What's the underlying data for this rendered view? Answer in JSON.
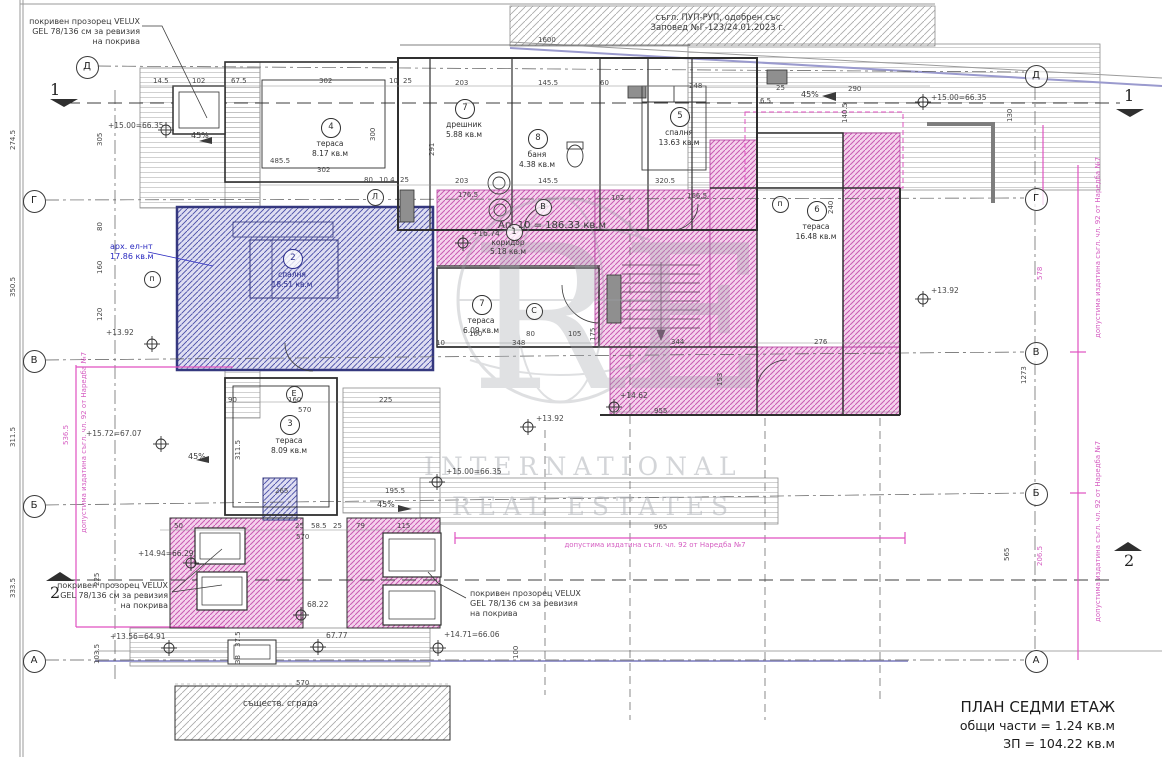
{
  "colors": {
    "regulation_pink": "#d55ec2",
    "hatch_pink": "#c855b4",
    "hatch_blue": "#454aa2",
    "note_blue": "#2a2ac0",
    "wall": "#2f2f2f",
    "roof_edge_purple": "#9a9ace"
  },
  "title_block": {
    "line1": "ПЛАН СЕДМИ ЕТАЖ",
    "line2": "общи части = 1.24 кв.м",
    "line3": "ЗП = 104.22 кв.м"
  },
  "watermark": {
    "monogram": "RE",
    "line1": "INTERNATIONAL",
    "line2": "REAL ESTATES"
  },
  "apartment_total": "Ап. 10 = 186.33 кв.м",
  "rooms": [
    {
      "num": "4",
      "name": "тераса",
      "area": "8.17 кв.м",
      "x": 330,
      "y": 118
    },
    {
      "num": "7",
      "name": "дрешник",
      "area": "5.88 кв.м",
      "x": 464,
      "y": 99
    },
    {
      "num": "8",
      "name": "баня",
      "area": "4.38 кв.м",
      "x": 537,
      "y": 129
    },
    {
      "num": "5",
      "name": "спалня",
      "area": "13.63 кв.м",
      "x": 679,
      "y": 107
    },
    {
      "num": "6",
      "name": "тераса",
      "area": "16.48 кв.м",
      "x": 816,
      "y": 201
    },
    {
      "num": "2",
      "name": "спалня",
      "area": "18.51 кв.м",
      "x": 292,
      "y": 249,
      "blue": true
    },
    {
      "num": "7",
      "name": "тераса",
      "area": "6.09 кв.м",
      "x": 481,
      "y": 295
    },
    {
      "num": "3",
      "name": "тераса",
      "area": "8.09 кв.м",
      "x": 289,
      "y": 415
    }
  ],
  "annotations": [
    {
      "id": "approval-note",
      "t": "съгл. ПУП-РУП, одобрен със\nЗаповед №Г-123/24.01.2023 г.",
      "x": 718,
      "y": 13,
      "s": 8.5,
      "a": "c"
    },
    {
      "id": "velux-note-top-left",
      "t": "покривен прозорец VELUX\nGEL 78/136 см за ревизия\nна покрива",
      "x": 140,
      "y": 17,
      "s": 8,
      "a": "r"
    },
    {
      "id": "velux-note-bottom-left",
      "t": "покривен прозорец VELUX\nGEL 78/136 см за ревизия\nна покрива",
      "x": 168,
      "y": 581,
      "s": 8,
      "a": "r"
    },
    {
      "id": "velux-note-bottom-center",
      "t": "покривен прозорец VELUX\nGEL 78/136 см за ревизия\nна покрива",
      "x": 470,
      "y": 589,
      "s": 8,
      "a": "l"
    },
    {
      "id": "arch-element-note",
      "t": "арх. ел-нт\n17.86 кв.м",
      "x": 110,
      "y": 242,
      "s": 8,
      "a": "l",
      "col": "#2a2ac0"
    },
    {
      "id": "apartment-total",
      "t": "Ап. 10 = 186.33 кв.м",
      "x": 498,
      "y": 220,
      "s": 10,
      "a": "l"
    },
    {
      "id": "corridor-label",
      "t": "коридор\n5.18 кв.м",
      "x": 508,
      "y": 238,
      "s": 7.5,
      "a": "c"
    },
    {
      "id": "existing-building-label",
      "t": "съществ. сграда",
      "x": 243,
      "y": 699,
      "s": 8.5,
      "a": "l"
    },
    {
      "id": "regulation-note-mid",
      "t": "допустима издатина съгл. чл. 92 от Наредба №7",
      "x": 655,
      "y": 541,
      "s": 7,
      "a": "c",
      "col": "#d55ec2"
    },
    {
      "id": "regulation-note-left",
      "t": "допустима издатина съгл. чл. 92 от Наредба №7",
      "x": 80,
      "y": 533,
      "s": 7,
      "rot": 1,
      "col": "#d55ec2"
    },
    {
      "id": "regulation-note-right-1",
      "t": "допустима издатина съгл. чл. 92 от Наредба №7",
      "x": 1094,
      "y": 338,
      "s": 7,
      "rot": 1,
      "col": "#d55ec2"
    },
    {
      "id": "regulation-note-right-2",
      "t": "допустима издатина съгл. чл. 92 от Наредба №7",
      "x": 1094,
      "y": 622,
      "s": 7,
      "rot": 1,
      "col": "#d55ec2"
    },
    {
      "id": "slope-45-a",
      "t": "45%",
      "x": 191,
      "y": 131,
      "s": 8,
      "a": "l"
    },
    {
      "id": "slope-45-b",
      "t": "45%",
      "x": 801,
      "y": 90,
      "s": 8,
      "a": "l"
    },
    {
      "id": "slope-45-c",
      "t": "45%",
      "x": 188,
      "y": 452,
      "s": 8,
      "a": "l"
    },
    {
      "id": "slope-45-d",
      "t": "45%",
      "x": 377,
      "y": 500,
      "s": 8,
      "a": "l"
    }
  ],
  "elevations": [
    {
      "t": "+15.00=66.35",
      "x": 108,
      "y": 121
    },
    {
      "t": "+15.00=66.35",
      "x": 931,
      "y": 93
    },
    {
      "t": "+16.74",
      "x": 472,
      "y": 229
    },
    {
      "t": "+13.92",
      "x": 106,
      "y": 328
    },
    {
      "t": "+13.92",
      "x": 536,
      "y": 414
    },
    {
      "t": "+13.92",
      "x": 931,
      "y": 286
    },
    {
      "t": "+15.72=67.07",
      "x": 86,
      "y": 429
    },
    {
      "t": "+15.00=66.35",
      "x": 446,
      "y": 467
    },
    {
      "t": "+14.94=66.29",
      "x": 138,
      "y": 549
    },
    {
      "t": "+13.56=64.91",
      "x": 110,
      "y": 632
    },
    {
      "t": "68.22",
      "x": 307,
      "y": 600
    },
    {
      "t": "67.77",
      "x": 326,
      "y": 631
    },
    {
      "t": "+14.71=66.06",
      "x": 444,
      "y": 630
    },
    {
      "t": "+14.62",
      "x": 620,
      "y": 391
    }
  ],
  "dims": [
    {
      "t": "1600",
      "x": 538,
      "y": 36
    },
    {
      "t": "14.5",
      "x": 153,
      "y": 77
    },
    {
      "t": "102",
      "x": 192,
      "y": 77
    },
    {
      "t": "67.5",
      "x": 231,
      "y": 77
    },
    {
      "t": "302",
      "x": 319,
      "y": 77
    },
    {
      "t": "10",
      "x": 389,
      "y": 77
    },
    {
      "t": "25",
      "x": 403,
      "y": 77
    },
    {
      "t": "203",
      "x": 455,
      "y": 79
    },
    {
      "t": "145.5",
      "x": 538,
      "y": 79
    },
    {
      "t": "60",
      "x": 600,
      "y": 79
    },
    {
      "t": "248",
      "x": 689,
      "y": 82
    },
    {
      "t": "25",
      "x": 776,
      "y": 84
    },
    {
      "t": "290",
      "x": 848,
      "y": 85
    },
    {
      "t": "6.5",
      "x": 760,
      "y": 97
    },
    {
      "t": "485.5",
      "x": 270,
      "y": 157
    },
    {
      "t": "302",
      "x": 317,
      "y": 166
    },
    {
      "t": "80",
      "x": 364,
      "y": 176
    },
    {
      "t": "10.4",
      "x": 379,
      "y": 176
    },
    {
      "t": "25",
      "x": 400,
      "y": 176
    },
    {
      "t": "203",
      "x": 455,
      "y": 177
    },
    {
      "t": "176.5",
      "x": 458,
      "y": 191
    },
    {
      "t": "145.5",
      "x": 538,
      "y": 177
    },
    {
      "t": "102",
      "x": 611,
      "y": 194
    },
    {
      "t": "320.5",
      "x": 655,
      "y": 177
    },
    {
      "t": "166.5",
      "x": 687,
      "y": 192
    },
    {
      "t": "300",
      "x": 369,
      "y": 141,
      "r": 1
    },
    {
      "t": "291",
      "x": 428,
      "y": 156,
      "r": 1
    },
    {
      "t": "140.5",
      "x": 841,
      "y": 123,
      "r": 1
    },
    {
      "t": "130",
      "x": 1006,
      "y": 122,
      "r": 1
    },
    {
      "t": "240",
      "x": 827,
      "y": 214,
      "r": 1
    },
    {
      "t": "160",
      "x": 469,
      "y": 330
    },
    {
      "t": "80",
      "x": 526,
      "y": 330
    },
    {
      "t": "105",
      "x": 568,
      "y": 330
    },
    {
      "t": "10",
      "x": 436,
      "y": 339
    },
    {
      "t": "348",
      "x": 512,
      "y": 339
    },
    {
      "t": "175",
      "x": 589,
      "y": 341,
      "r": 1
    },
    {
      "t": "153",
      "x": 716,
      "y": 386,
      "r": 1
    },
    {
      "t": "344",
      "x": 671,
      "y": 338
    },
    {
      "t": "276",
      "x": 814,
      "y": 338
    },
    {
      "t": "955",
      "x": 654,
      "y": 407
    },
    {
      "t": "965",
      "x": 654,
      "y": 523
    },
    {
      "t": "90",
      "x": 228,
      "y": 396
    },
    {
      "t": "160",
      "x": 288,
      "y": 396
    },
    {
      "t": "225",
      "x": 379,
      "y": 396
    },
    {
      "t": "570",
      "x": 298,
      "y": 406
    },
    {
      "t": "265",
      "x": 275,
      "y": 487
    },
    {
      "t": "195.5",
      "x": 385,
      "y": 487
    },
    {
      "t": "311.5",
      "x": 234,
      "y": 460,
      "r": 1
    },
    {
      "t": "50",
      "x": 174,
      "y": 522
    },
    {
      "t": "25",
      "x": 295,
      "y": 522
    },
    {
      "t": "58.5",
      "x": 311,
      "y": 522
    },
    {
      "t": "25",
      "x": 333,
      "y": 522
    },
    {
      "t": "79",
      "x": 356,
      "y": 522
    },
    {
      "t": "115",
      "x": 397,
      "y": 522
    },
    {
      "t": "570",
      "x": 296,
      "y": 533
    },
    {
      "t": "570",
      "x": 296,
      "y": 679
    },
    {
      "t": "305",
      "x": 96,
      "y": 146,
      "r": 1
    },
    {
      "t": "80",
      "x": 96,
      "y": 231,
      "r": 1
    },
    {
      "t": "160",
      "x": 96,
      "y": 274,
      "r": 1
    },
    {
      "t": "120",
      "x": 96,
      "y": 321,
      "r": 1
    },
    {
      "t": "225",
      "x": 93,
      "y": 586,
      "r": 1
    },
    {
      "t": "103.5",
      "x": 93,
      "y": 664,
      "r": 1
    },
    {
      "t": "274.5",
      "x": 9,
      "y": 150,
      "r": 1
    },
    {
      "t": "350.5",
      "x": 9,
      "y": 297,
      "r": 1
    },
    {
      "t": "311.5",
      "x": 9,
      "y": 447,
      "r": 1
    },
    {
      "t": "333.5",
      "x": 9,
      "y": 598,
      "r": 1
    },
    {
      "t": "37.5",
      "x": 234,
      "y": 647,
      "r": 1
    },
    {
      "t": "38",
      "x": 234,
      "y": 664,
      "r": 1
    },
    {
      "t": "100",
      "x": 512,
      "y": 659,
      "r": 1
    },
    {
      "t": "578",
      "x": 1036,
      "y": 280,
      "r": 1,
      "c": "p"
    },
    {
      "t": "1273",
      "x": 1020,
      "y": 384,
      "r": 1
    },
    {
      "t": "206.5",
      "x": 1036,
      "y": 566,
      "r": 1,
      "c": "p"
    },
    {
      "t": "565",
      "x": 1003,
      "y": 561,
      "r": 1
    },
    {
      "t": "536.5",
      "x": 62,
      "y": 445,
      "r": 1,
      "c": "p"
    }
  ],
  "axis_circles": [
    {
      "l": "Д",
      "x": 86,
      "y": 66,
      "e": 1
    },
    {
      "l": "Г",
      "x": 33,
      "y": 200,
      "e": 1
    },
    {
      "l": "В",
      "x": 33,
      "y": 360,
      "e": 1
    },
    {
      "l": "Б",
      "x": 33,
      "y": 505,
      "e": 1
    },
    {
      "l": "А",
      "x": 33,
      "y": 660,
      "e": 1
    },
    {
      "l": "Д",
      "x": 1035,
      "y": 75,
      "e": 1
    },
    {
      "l": "Г",
      "x": 1035,
      "y": 198,
      "e": 1
    },
    {
      "l": "В",
      "x": 1035,
      "y": 352,
      "e": 1
    },
    {
      "l": "Б",
      "x": 1035,
      "y": 493,
      "e": 1
    },
    {
      "l": "А",
      "x": 1035,
      "y": 660,
      "e": 1
    },
    {
      "l": "Л",
      "x": 374,
      "y": 196
    },
    {
      "l": "В",
      "x": 542,
      "y": 206
    },
    {
      "l": "п",
      "x": 151,
      "y": 278
    },
    {
      "l": "С",
      "x": 533,
      "y": 310
    },
    {
      "l": "Е",
      "x": 293,
      "y": 393
    },
    {
      "l": "п",
      "x": 779,
      "y": 203
    },
    {
      "l": "1",
      "x": 513,
      "y": 231
    }
  ],
  "section_marks": [
    {
      "n": "1",
      "x": 50,
      "y": 80
    },
    {
      "n": "1",
      "x": 1124,
      "y": 86
    },
    {
      "n": "2",
      "x": 50,
      "y": 583
    },
    {
      "n": "2",
      "x": 1124,
      "y": 551
    }
  ]
}
